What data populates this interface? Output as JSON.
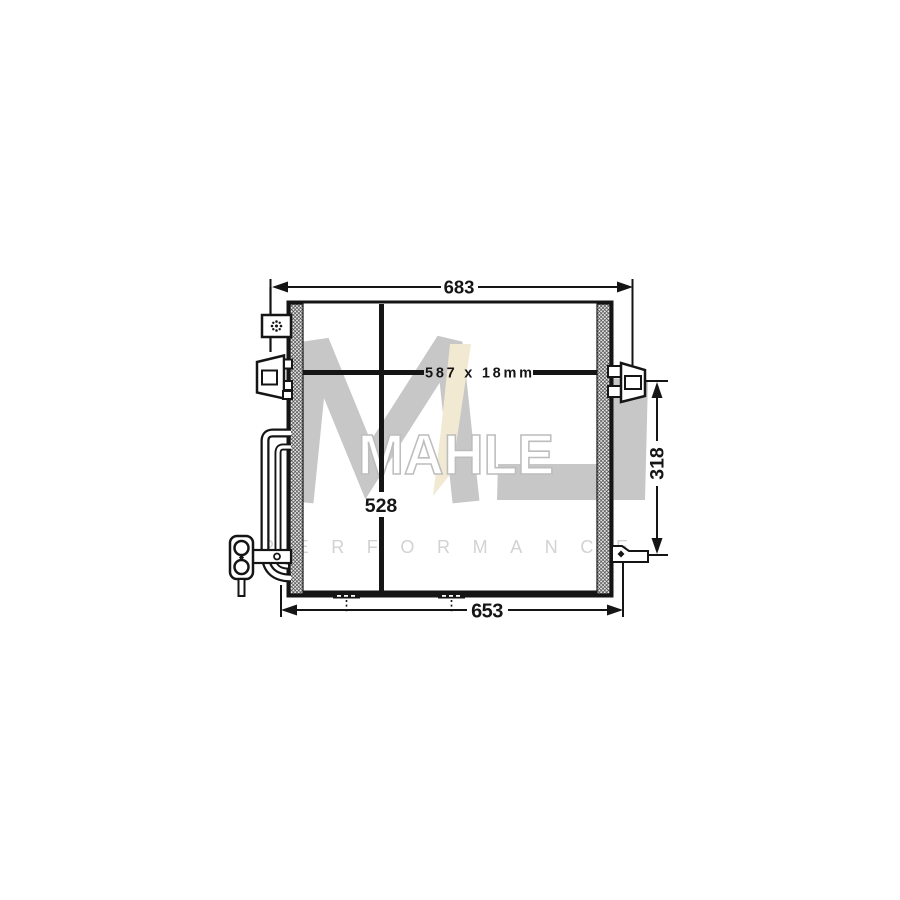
{
  "page": {
    "background": "#ffffff",
    "description": "Technical line drawing of an automotive A/C condenser with dimension annotations"
  },
  "drawing": {
    "line_color": "#151515",
    "labels": {
      "width_overall": "683",
      "core_size": "587 x 18mm",
      "height_core": "528",
      "bracket_offset": "318",
      "width_lower": "653"
    }
  },
  "watermark": {
    "brand": "MAHLE",
    "subtitle": "PERFORMANCE",
    "monogram_letters": "ML",
    "colors": {
      "monogram_gray": "#c7c7c7",
      "monogram_beige": "#f1e9d2",
      "brand_outline": "#bdbdbd",
      "brand_fill": "#ffffff",
      "subtitle_gray": "#d2d2d2"
    }
  }
}
